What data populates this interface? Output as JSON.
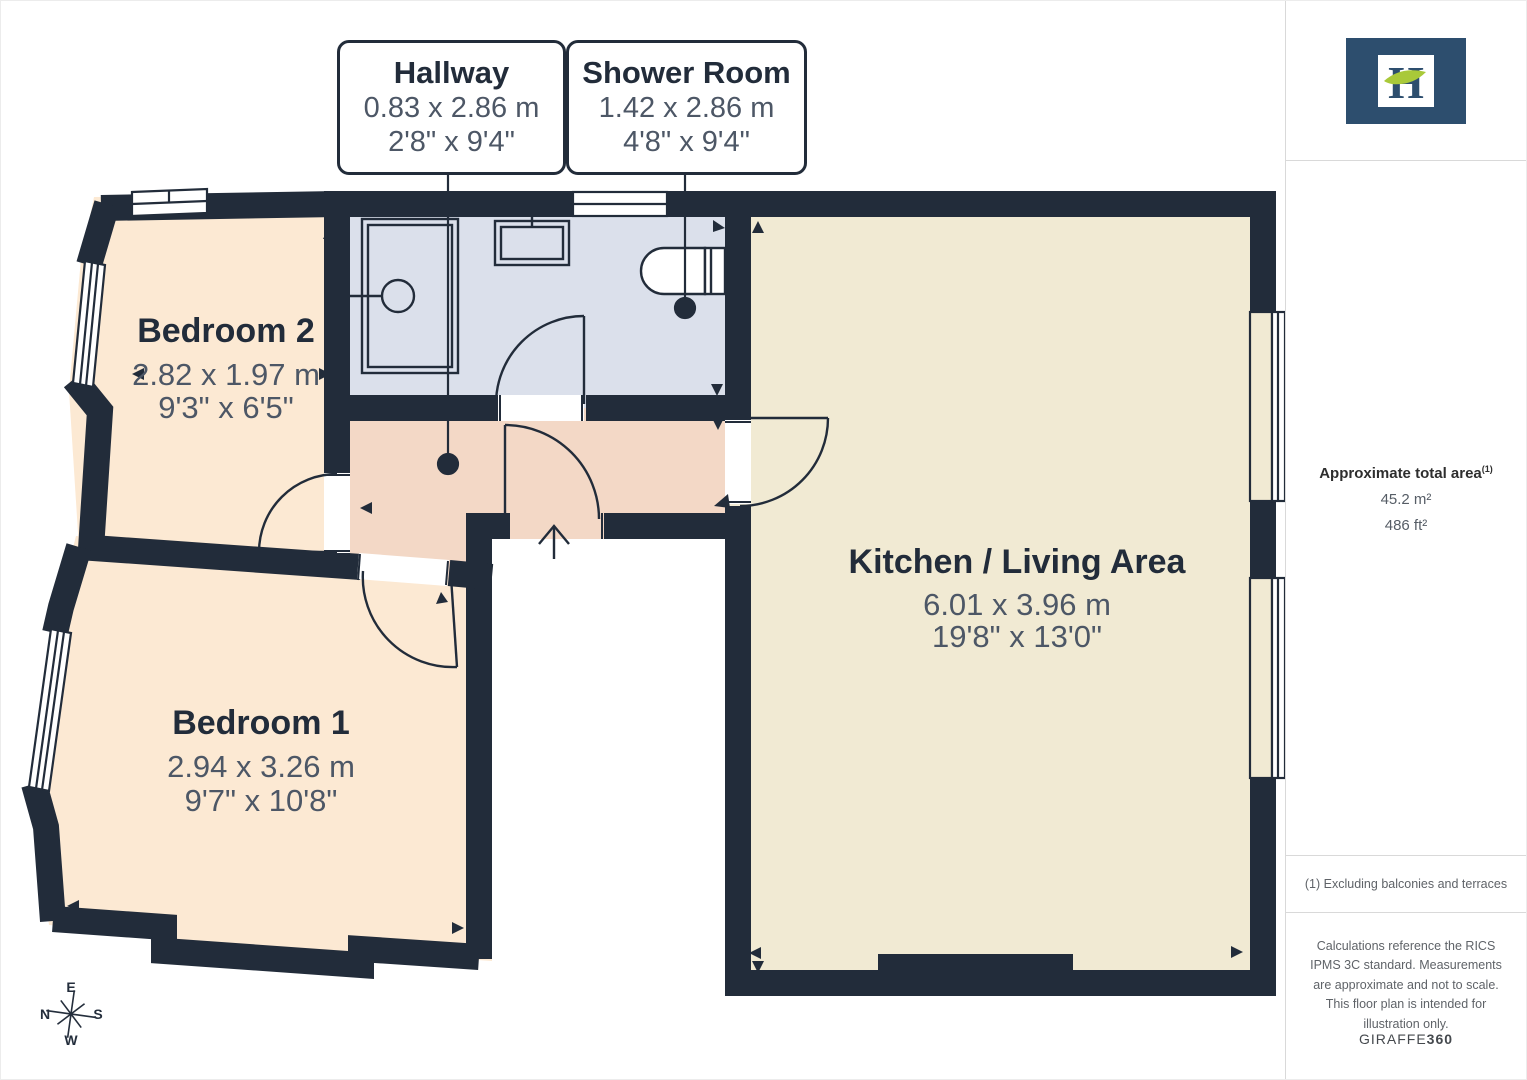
{
  "callouts": [
    {
      "title": "Hallway",
      "metric": "0.83 x 2.86 m",
      "imperial": "2'8\" x 9'4\""
    },
    {
      "title": "Shower Room",
      "metric": "1.42 x 2.86 m",
      "imperial": "4'8\" x 9'4\""
    }
  ],
  "rooms": [
    {
      "name": "Bedroom 2",
      "metric": "2.82 x 1.97 m",
      "imperial": "9'3\" x 6'5\""
    },
    {
      "name": "Bedroom 1",
      "metric": "2.94 x 3.26 m",
      "imperial": "9'7\" x 10'8\""
    },
    {
      "name": "Kitchen / Living Area",
      "metric": "6.01 x 3.96 m",
      "imperial": "19'8\" x 13'0\""
    }
  ],
  "compass": {
    "north": "N",
    "east": "E",
    "south": "S",
    "west": "W"
  },
  "sidebar": {
    "logo_letter": "H",
    "area_heading": "Approximate total area",
    "area_marker": "(1)",
    "area_m2": "45.2 m²",
    "area_ft2": "486 ft²",
    "footnote": "(1) Excluding balconies and terraces",
    "disclaimer": "Calculations reference the RICS IPMS 3C standard. Measurements are approximate and not to scale. This floor plan is intended for illustration only.",
    "brand": "GIRAFFE",
    "brand_bold": "360"
  },
  "colors": {
    "wall": "#222c3a",
    "bedroom_fill": "#fce9d3",
    "hallway_fill": "#f3d8c6",
    "shower_fill": "#dbe0eb",
    "kitchen_fill": "#f1ead3",
    "dim_text": "#4d5766",
    "logo_navy": "#2d4e6e",
    "logo_leaf_green": "#a9c939"
  }
}
